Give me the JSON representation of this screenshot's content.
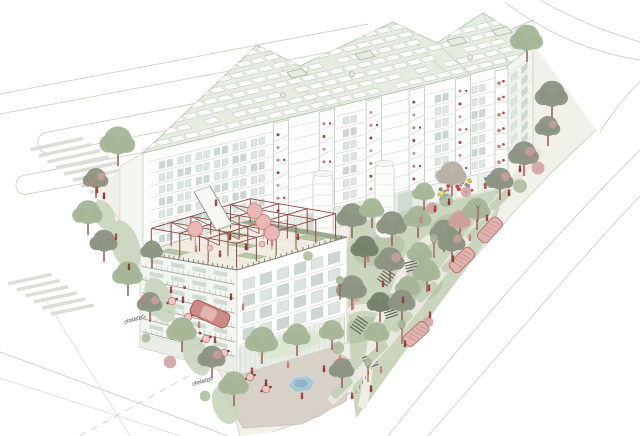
{
  "palette": {
    "background": "#ffffff",
    "line": "#d4d4ce",
    "line_soft": "#e2e2dc",
    "sidewalk": "#f1f0e9",
    "walkband": "#e9e8e0",
    "plaza": "#d8d1c8",
    "lawn": "#c9d5bd",
    "lawn_light": "#dde4d2",
    "lawn_dark": "#a9ba9b",
    "verge": "#c3d0b5",
    "hedge": "#8fa183",
    "roof": "#e7ece2",
    "panel": "#fbfcf9",
    "roof_line": "#b7c1b4",
    "facade": "#fdfdfc",
    "facade_shade": "#f3f5f1",
    "facade_line": "#c6cec6",
    "window": "#dde6de",
    "window_dark": "#ccd8cf",
    "glass": "#e9ede8",
    "glass_dark": "#d2dbd3",
    "deck": "#efece1",
    "deck_line": "#b9b7a8",
    "pergola": "#8e4a48",
    "umbrella": "#e9b7b4",
    "umbrella_line": "#c4817d",
    "accent": "#a6453f",
    "accent_dark": "#8d3b38",
    "accent_soft": "#c8807b",
    "trunk": "#9b5a52",
    "tree_light": "#a5b697",
    "tree_gray": "#8c9482",
    "tree_dark": "#75826b",
    "tree_pink": "#cf9f9e",
    "tree_taupe": "#b7b1a4",
    "pond": "#aac7d4",
    "pond_deep": "#8fb6c6",
    "pond_rim": "#d6d6d0",
    "steps": "#5d5f57",
    "fence": "#6a6d63",
    "mural": [
      "#e3bc3c",
      "#c14e48",
      "#4f7ab8",
      "#6fa05a",
      "#c77fae"
    ]
  },
  "scene": {
    "buildings": {
      "main_slab": {
        "floors": 8,
        "window_bays": 18,
        "balcony_stacks": 5,
        "sawtooth_peaks": 4,
        "roof_panel_rows": 9,
        "roof_skylights": 4
      },
      "low_block": {
        "floors": 5,
        "window_bays": 6,
        "pergola_bays": 5,
        "umbrellas": 4
      }
    },
    "trees": [
      [
        118,
        166,
        14,
        "l"
      ],
      [
        96,
        198,
        10,
        "g"
      ],
      [
        88,
        235,
        12,
        "l"
      ],
      [
        104,
        262,
        11,
        "g"
      ],
      [
        128,
        296,
        12,
        "l"
      ],
      [
        150,
        322,
        10,
        "g"
      ],
      [
        182,
        352,
        12,
        "l"
      ],
      [
        212,
        378,
        11,
        "g"
      ],
      [
        234,
        406,
        12,
        "l"
      ],
      [
        152,
        268,
        9,
        "g"
      ],
      [
        262,
        364,
        13,
        "l"
      ],
      [
        297,
        356,
        11,
        "l"
      ],
      [
        332,
        350,
        10,
        "l"
      ],
      [
        352,
        238,
        12,
        "g"
      ],
      [
        372,
        228,
        10,
        "l"
      ],
      [
        392,
        246,
        12,
        "g"
      ],
      [
        418,
        238,
        11,
        "l"
      ],
      [
        365,
        268,
        11,
        "d"
      ],
      [
        390,
        282,
        12,
        "g"
      ],
      [
        420,
        272,
        10,
        "l"
      ],
      [
        352,
        310,
        12,
        "g"
      ],
      [
        380,
        322,
        10,
        "d"
      ],
      [
        408,
        306,
        10,
        "l"
      ],
      [
        444,
        252,
        11,
        "g"
      ],
      [
        460,
        238,
        9,
        "p"
      ],
      [
        500,
        200,
        11,
        "g"
      ],
      [
        477,
        230,
        11,
        "l"
      ],
      [
        452,
        262,
        11,
        "g"
      ],
      [
        427,
        292,
        11,
        "l"
      ],
      [
        402,
        322,
        11,
        "g"
      ],
      [
        377,
        352,
        10,
        "l"
      ],
      [
        342,
        388,
        10,
        "g"
      ],
      [
        552,
        118,
        13,
        "g"
      ],
      [
        548,
        146,
        10,
        "g"
      ],
      [
        524,
        176,
        12,
        "g"
      ],
      [
        527,
        62,
        13,
        "l"
      ],
      [
        452,
        196,
        12,
        "t"
      ],
      [
        424,
        210,
        9,
        "l"
      ]
    ],
    "young_trees": [
      [
        478,
        222
      ],
      [
        434,
        258
      ],
      [
        402,
        344
      ],
      [
        368,
        382
      ],
      [
        340,
        300
      ]
    ],
    "shrubs": [
      [
        432,
        208,
        "p"
      ],
      [
        446,
        200,
        "g"
      ],
      [
        466,
        192,
        "p"
      ],
      [
        308,
        256,
        "g"
      ],
      [
        355,
        296,
        "p"
      ],
      [
        392,
        298,
        "g"
      ],
      [
        428,
        322,
        "p"
      ],
      [
        338,
        348,
        "g"
      ],
      [
        146,
        338,
        "g"
      ],
      [
        170,
        362,
        "p"
      ],
      [
        205,
        396,
        "g"
      ],
      [
        98,
        242,
        "g"
      ],
      [
        538,
        168,
        "p"
      ],
      [
        520,
        186,
        "g"
      ]
    ],
    "people": [
      [
        97,
        193
      ],
      [
        104,
        199
      ],
      [
        92,
        186
      ],
      [
        116,
        240
      ],
      [
        129,
        270
      ],
      [
        143,
        302
      ],
      [
        171,
        293
      ],
      [
        183,
        303
      ],
      [
        199,
        328
      ],
      [
        215,
        343
      ],
      [
        231,
        300
      ],
      [
        243,
        310
      ],
      [
        252,
        374
      ],
      [
        266,
        386
      ],
      [
        288,
        368
      ],
      [
        302,
        399
      ],
      [
        324,
        372
      ],
      [
        340,
        362
      ],
      [
        352,
        399
      ],
      [
        371,
        392
      ],
      [
        368,
        262
      ],
      [
        383,
        287
      ],
      [
        403,
        303
      ],
      [
        353,
        309
      ],
      [
        429,
        291
      ],
      [
        453,
        262
      ],
      [
        470,
        241
      ],
      [
        487,
        221
      ],
      [
        509,
        196
      ],
      [
        533,
        160
      ],
      [
        430,
        318
      ],
      [
        405,
        347
      ],
      [
        381,
        373
      ],
      [
        435,
        212
      ],
      [
        449,
        205
      ],
      [
        421,
        223
      ],
      [
        216,
        206
      ],
      [
        520,
        172
      ]
    ],
    "deck_people": [
      [
        196,
        252
      ],
      [
        220,
        257
      ],
      [
        246,
        250
      ],
      [
        272,
        246
      ],
      [
        298,
        240
      ],
      [
        230,
        240
      ]
    ],
    "tables_cafe": [
      [
        172,
        301
      ],
      [
        188,
        317
      ],
      [
        206,
        339
      ],
      [
        224,
        353
      ]
    ],
    "tables_plaza": [
      [
        250,
        377
      ],
      [
        266,
        389
      ]
    ],
    "tables_deck": [
      [
        210,
        248
      ],
      [
        262,
        244
      ]
    ],
    "bikes": [
      [
        126,
        322
      ],
      [
        194,
        384
      ]
    ],
    "car": {
      "x": 210,
      "y": 314,
      "rot": 24
    },
    "parked_cars": [
      [
        490,
        230,
        -47
      ],
      [
        462,
        260,
        -45
      ],
      [
        416,
        334,
        -42
      ]
    ],
    "pond": {
      "x": 300,
      "y": 385
    },
    "umbrella_cells": [
      [
        0,
        1
      ],
      [
        1,
        3
      ],
      [
        2,
        2
      ],
      [
        0,
        4
      ]
    ],
    "planter_cells": [
      [
        0,
        0
      ],
      [
        2,
        1
      ],
      [
        1,
        2
      ],
      [
        0,
        3
      ],
      [
        2,
        4
      ]
    ],
    "crosswalks": [
      {
        "x": 30,
        "y": 148,
        "stripes": 8,
        "len": 54
      },
      {
        "x": 8,
        "y": 282,
        "stripes": 6,
        "len": 44
      }
    ]
  }
}
